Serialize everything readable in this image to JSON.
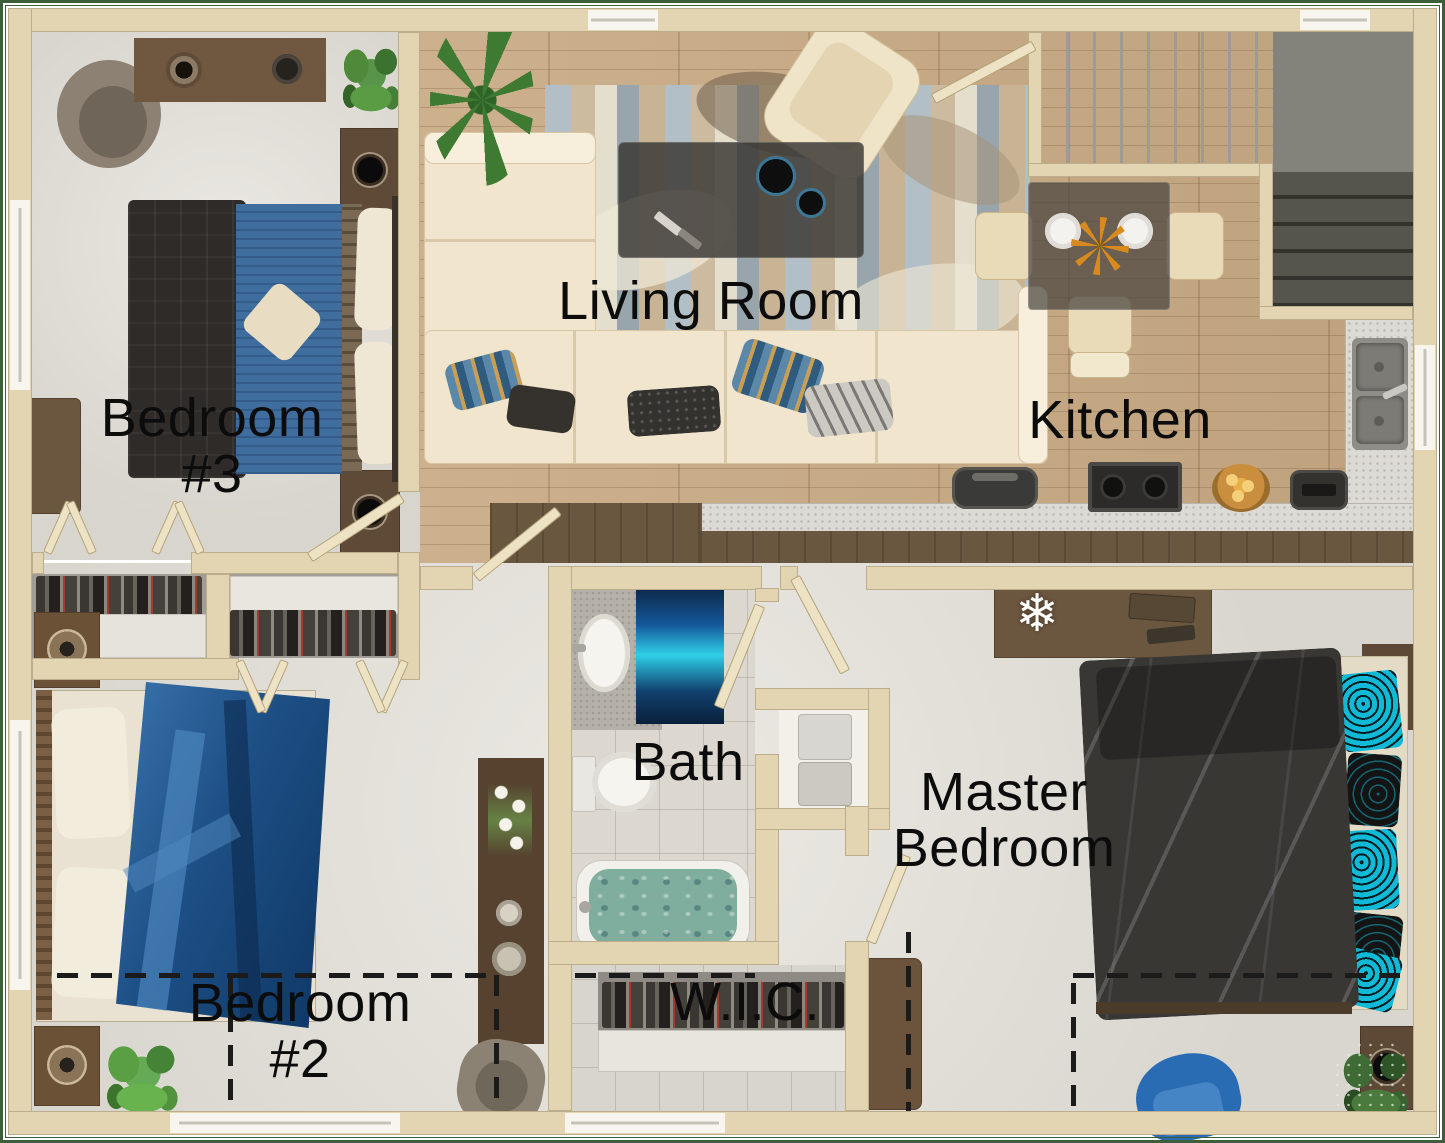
{
  "title": "Apartment floor plan (top-down 3D render)",
  "rooms": {
    "living": {
      "name": "Living Room"
    },
    "kitchen": {
      "name": "Kitchen"
    },
    "bedroom3": {
      "line1": "Bedroom",
      "line2": "#3"
    },
    "bedroom2": {
      "line1": "Bedroom",
      "line2": "#2"
    },
    "master": {
      "line1": "Master",
      "line2": "Bedroom"
    },
    "bath": {
      "name": "Bath"
    },
    "wic": {
      "name": "W.I.C."
    }
  },
  "palette": {
    "wall": "#e3d5b2",
    "wall_edge": "#bcae8c",
    "page_border_green": "#3c5e3b",
    "carpet": "#e1ded6",
    "wood_floor": "#c9aa84",
    "bath_tile": "#dcd8d0",
    "counter_speckle": "#dcdad5",
    "cabinet_wood": "#6a5740",
    "stair_light": "#cbc9c4",
    "stair_dark": "#45443d",
    "bed3_blue": "#3e6d9e",
    "bed2_blue": "#2e6399",
    "master_comforter": "#393734",
    "teal_accent": "#10b9d6",
    "chair_blue": "#2a6cb3",
    "sofa_cream": "#f1e6cd",
    "label_text": "#0c0c0c",
    "bath_rug_cyan": "#2fd0e8",
    "tub_water": "#7fae9f",
    "plant_green": "#4e8a3a"
  },
  "furniture": {
    "living_room": [
      "sectional-sofa",
      "throw-pillows",
      "area-rug",
      "coffee-table",
      "speakers",
      "remotes",
      "armchair",
      "palm-plant"
    ],
    "kitchen": [
      "dining-table",
      "dining-chairs",
      "plates",
      "flower-centerpiece",
      "stove",
      "pot",
      "candle-bowl",
      "toaster",
      "double-sink",
      "counter"
    ],
    "stairs": [
      "staircase-up",
      "stair-landing",
      "staircase-lower"
    ],
    "bedroom3": [
      "bed",
      "nightstands",
      "speakers",
      "desk",
      "round-chair",
      "plant",
      "bench",
      "closets-with-shoes"
    ],
    "bedroom2": [
      "bed-blue-cover",
      "nightstands-with-lamps",
      "plant",
      "tall-dresser",
      "orchid",
      "stool"
    ],
    "bath": [
      "sink-counter",
      "oval-sink",
      "toilet",
      "bathtub",
      "blue-rug",
      "linen-shelf-towels"
    ],
    "wic": [
      "shoe-rack"
    ],
    "master_bedroom": [
      "bed-dark-comforter",
      "teal-pillows",
      "nightstands",
      "speakers",
      "desk",
      "snowflake-decor",
      "blue-chair",
      "plant",
      "bench"
    ]
  },
  "annotations": {
    "dashed_lines": "dashed reference lines",
    "doors": "door swing leaves",
    "bifold_doors": "closet bi-fold markers"
  }
}
